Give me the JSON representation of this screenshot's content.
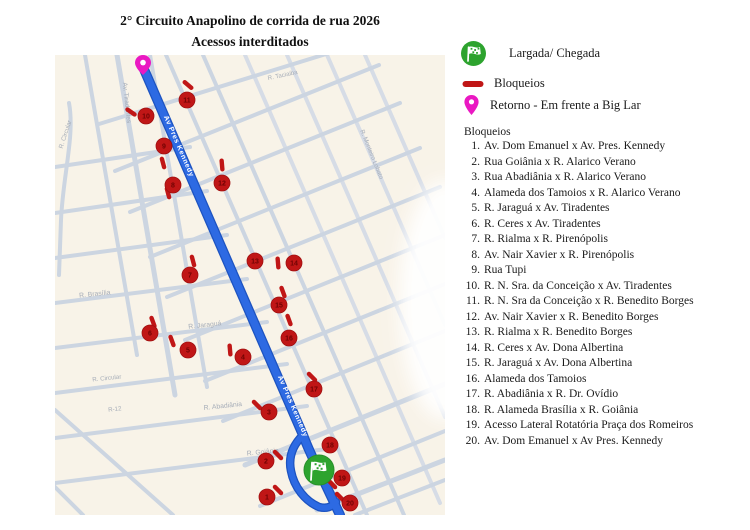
{
  "title": {
    "line1": "2° Circuito Anapolino de corrida de rua 2026",
    "line2": "Acessos interditados"
  },
  "legend": {
    "start_label": "Largada/ Chegada",
    "blockade_label": "Bloqueios",
    "return_label": "Retorno - Em frente a Big Lar",
    "list_title": "Bloqueios",
    "items": [
      "Av. Dom Emanuel x Av. Pres. Kennedy",
      "Rua Goiânia x R. Alarico Verano",
      "Rua Abadiânia x R. Alarico Verano",
      "Alameda dos Tamoios x R. Alarico Verano",
      "R. Jaraguá x Av. Tiradentes",
      "R. Ceres x Av. Tiradentes",
      "R. Rialma x R. Pirenópolis",
      "Av. Nair Xavier x R. Pirenópolis",
      "Rua Tupi",
      "R. N. Sra. da Conceição x Av. Tiradentes",
      "R. N. Sra da Conceição x R. Benedito Borges",
      "Av. Nair Xavier x R. Benedito Borges",
      "R. Rialma x R. Benedito Borges",
      "R. Ceres x Av. Dona Albertina",
      "R. Jaraguá x Av. Dona Albertina",
      "Alameda dos Tamoios",
      "R. Abadiânia x R. Dr. Ovídio",
      "R. Alameda Brasília x R. Goiânia",
      "Acesso Lateral Rotatória Praça dos Romeiros",
      "Av. Dom Emanuel x Av Pres. Kennedy"
    ]
  },
  "map": {
    "route_label": "Av Pres Kennedy",
    "route_label_positions": [
      {
        "x": 122,
        "y": 92,
        "r": 66.5
      },
      {
        "x": 236,
        "y": 352,
        "r": 66.5
      }
    ],
    "street_labels": [
      {
        "text": "Av. Tiradentes",
        "x": 70,
        "y": 48,
        "r": 84,
        "size": 6.5
      },
      {
        "text": "R. Circular",
        "x": 12,
        "y": 80,
        "r": -72,
        "size": 6.2
      },
      {
        "text": "R. Brasília",
        "x": 40,
        "y": 241,
        "r": -6,
        "size": 6.8
      },
      {
        "text": "R. Jaraguá",
        "x": 150,
        "y": 272,
        "r": -6,
        "size": 6.8
      },
      {
        "text": "R. Circular",
        "x": 52,
        "y": 325,
        "r": -6,
        "size": 6.2
      },
      {
        "text": "R-12",
        "x": 60,
        "y": 356,
        "r": -6,
        "size": 6.2
      },
      {
        "text": "R. Abadiânia",
        "x": 168,
        "y": 353,
        "r": -6,
        "size": 6.8
      },
      {
        "text": "R. Goiânia",
        "x": 208,
        "y": 399,
        "r": -6,
        "size": 6.8
      },
      {
        "text": "R. Taciaiba",
        "x": 228,
        "y": 22,
        "r": -12,
        "size": 6.2
      },
      {
        "text": "R. Monteiro Lobato",
        "x": 315,
        "y": 100,
        "r": 68,
        "size": 6.2
      }
    ],
    "markers": [
      {
        "n": 1,
        "x": 212,
        "y": 442
      },
      {
        "n": 2,
        "x": 211,
        "y": 406
      },
      {
        "n": 3,
        "x": 214,
        "y": 357
      },
      {
        "n": 4,
        "x": 188,
        "y": 302
      },
      {
        "n": 5,
        "x": 133,
        "y": 295
      },
      {
        "n": 6,
        "x": 95,
        "y": 278
      },
      {
        "n": 7,
        "x": 135,
        "y": 220
      },
      {
        "n": 8,
        "x": 118,
        "y": 130
      },
      {
        "n": 9,
        "x": 109,
        "y": 91
      },
      {
        "n": 10,
        "x": 91,
        "y": 61
      },
      {
        "n": 11,
        "x": 132,
        "y": 45
      },
      {
        "n": 12,
        "x": 167,
        "y": 128
      },
      {
        "n": 13,
        "x": 200,
        "y": 206
      },
      {
        "n": 14,
        "x": 239,
        "y": 208
      },
      {
        "n": 15,
        "x": 224,
        "y": 250
      },
      {
        "n": 16,
        "x": 234,
        "y": 283
      },
      {
        "n": 17,
        "x": 259,
        "y": 334
      },
      {
        "n": 18,
        "x": 275,
        "y": 390
      },
      {
        "n": 19,
        "x": 287,
        "y": 423
      },
      {
        "n": 20,
        "x": 295,
        "y": 448
      }
    ],
    "dashes": [
      {
        "x": 133,
        "y": 30,
        "a": 40
      },
      {
        "x": 76,
        "y": 57,
        "a": 35
      },
      {
        "x": 108,
        "y": 108,
        "a": 75
      },
      {
        "x": 113,
        "y": 138,
        "a": 75
      },
      {
        "x": 167,
        "y": 110,
        "a": 85
      },
      {
        "x": 138,
        "y": 206,
        "a": 75
      },
      {
        "x": 223,
        "y": 208,
        "a": 85
      },
      {
        "x": 228,
        "y": 237,
        "a": 70
      },
      {
        "x": 234,
        "y": 265,
        "a": 70
      },
      {
        "x": 98,
        "y": 267,
        "a": 70
      },
      {
        "x": 117,
        "y": 286,
        "a": 70
      },
      {
        "x": 175,
        "y": 295,
        "a": 85
      },
      {
        "x": 257,
        "y": 322,
        "a": 45
      },
      {
        "x": 202,
        "y": 350,
        "a": 45
      },
      {
        "x": 223,
        "y": 400,
        "a": 45
      },
      {
        "x": 223,
        "y": 435,
        "a": 45
      },
      {
        "x": 277,
        "y": 429,
        "a": 45
      },
      {
        "x": 285,
        "y": 442,
        "a": 45
      }
    ],
    "colors": {
      "route_blue": "#2d6ae3",
      "blockade_red": "#c01616",
      "start_green": "#2da32e",
      "return_pink": "#ea18c2",
      "road_gray": "#ccd5e1",
      "map_bg": "#f8f3e8",
      "label_gray": "#a6adb8"
    }
  }
}
